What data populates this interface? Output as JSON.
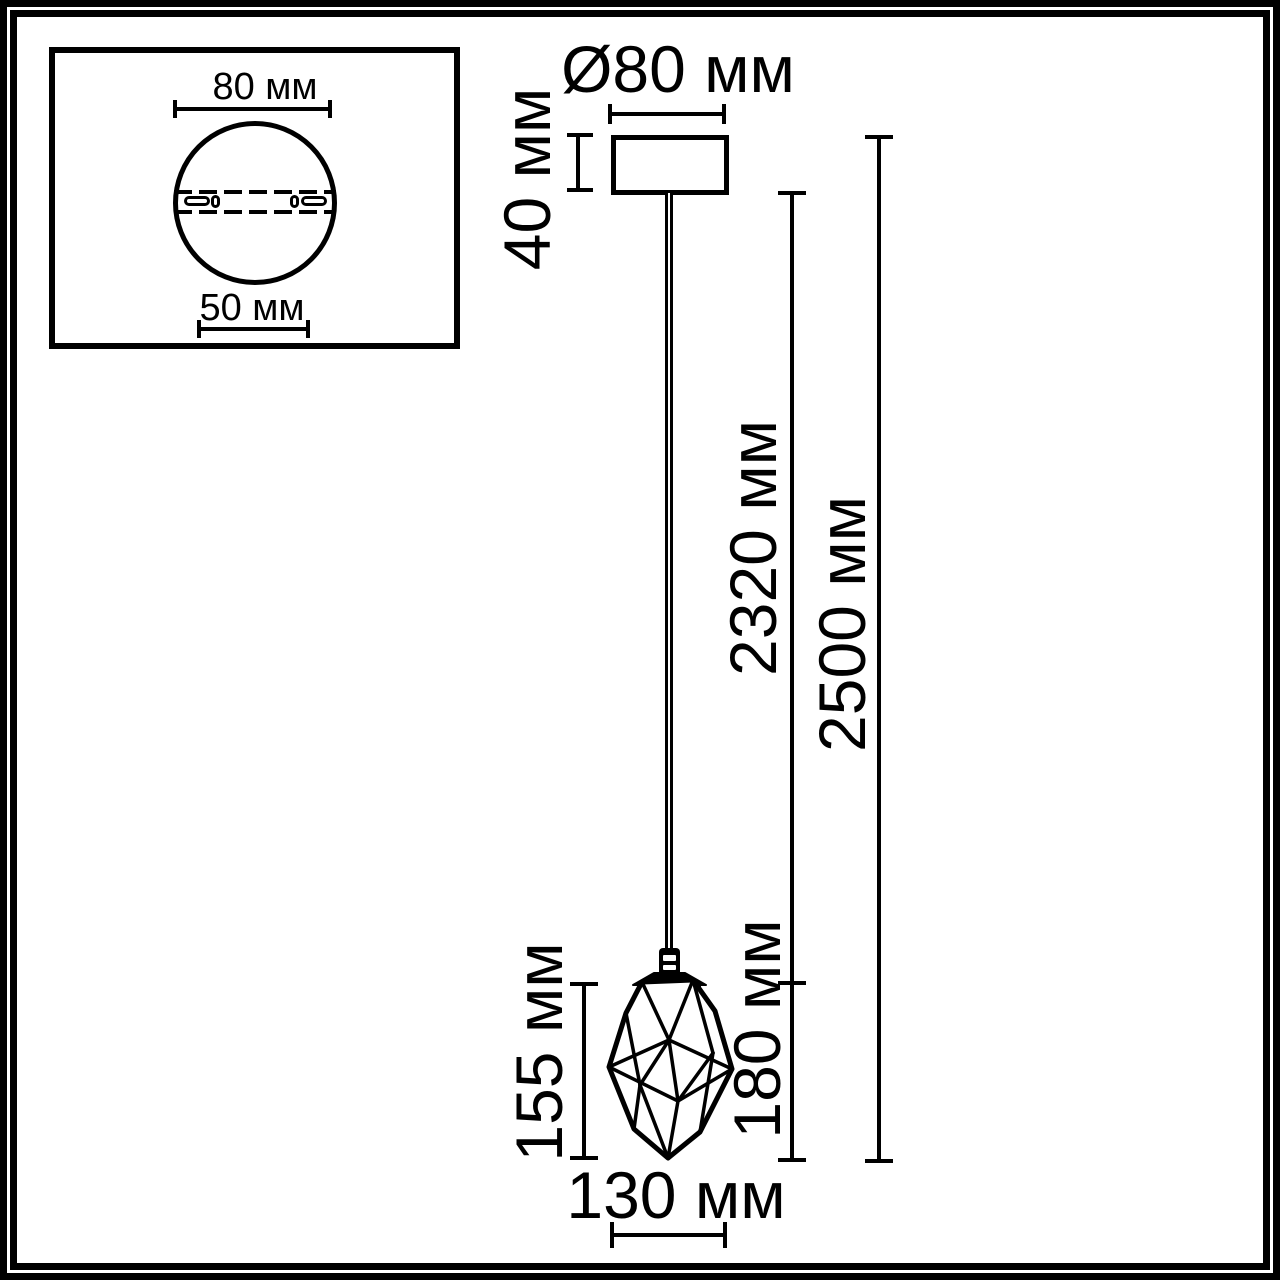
{
  "colors": {
    "line": "#000000",
    "background": "#ffffff"
  },
  "inset": {
    "plate_diameter_label": "80 мм",
    "mount_holes_distance_label": "50 мм"
  },
  "dimensions": {
    "canopy_diameter": "Ø80 мм",
    "canopy_height": "40 мм",
    "cord_length": "2320 мм",
    "overall_length": "2500 мм",
    "shade_glass_height": "155 мм",
    "shade_overall_height": "180 мм",
    "shade_width": "130 мм"
  }
}
